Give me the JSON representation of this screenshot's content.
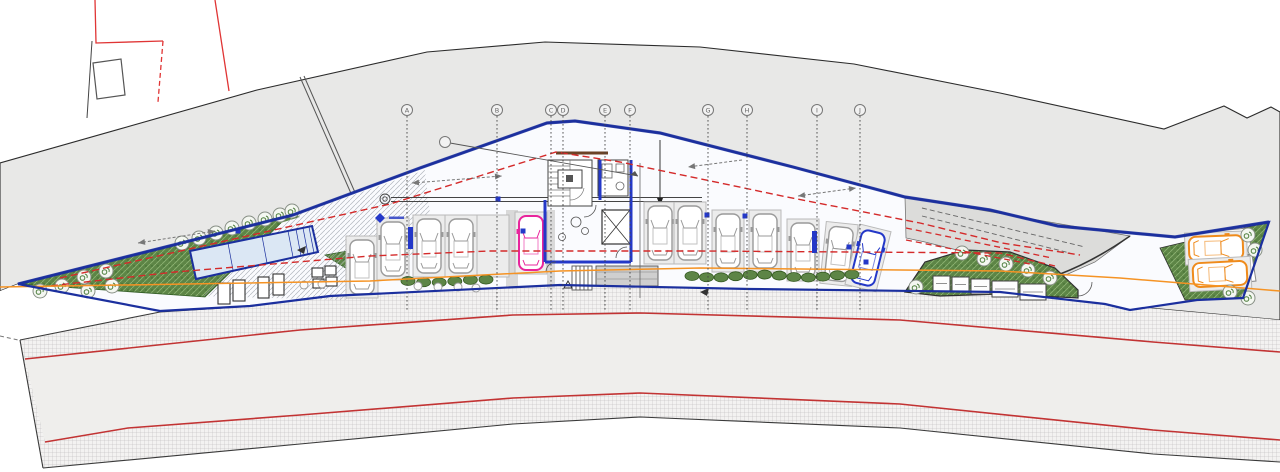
{
  "meta": {
    "drawing_type": "architectural-site-plan-garage-level",
    "canvas": {
      "width": 1280,
      "height": 472
    }
  },
  "colors": {
    "outline_blue": "#1b2f9e",
    "wall_blue": "#2438c8",
    "parcel_red": "#e03535",
    "dash_red": "#d42a2a",
    "road_red": "#c23333",
    "guide_orange": "#f59324",
    "site_gray": "#e8e8e7",
    "ramp_gray": "#dcdcda",
    "road_asphalt": "#efeeec",
    "hatch_gray": "#b5b5b5",
    "green_fill": "#5d8546",
    "green_dark": "#33591f",
    "car_gray": "#9a9a9a",
    "car_pink": "#e8259c",
    "car_blue": "#2438c8",
    "car_orange": "#ef8b1c",
    "line_black": "#2b2b2b"
  },
  "grid": {
    "bubble_y": 110,
    "line_top": 116,
    "line_bottom": 310,
    "bubbles": [
      {
        "label": "A",
        "x": 407
      },
      {
        "label": "B",
        "x": 497
      },
      {
        "label": "C",
        "x": 551
      },
      {
        "label": "D",
        "x": 563
      },
      {
        "label": "E",
        "x": 605
      },
      {
        "label": "F",
        "x": 630
      },
      {
        "label": "G",
        "x": 708
      },
      {
        "label": "H",
        "x": 747
      },
      {
        "label": "I",
        "x": 817
      },
      {
        "label": "J",
        "x": 860
      }
    ],
    "leader_tag": {
      "label": "",
      "cx": 445,
      "cy": 142,
      "x2": 638,
      "y2": 176
    }
  },
  "cars": {
    "gray": [
      {
        "cx": 362,
        "cy": 267,
        "rot": 0
      },
      {
        "cx": 393,
        "cy": 249,
        "rot": 0
      },
      {
        "cx": 429,
        "cy": 246,
        "rot": 0
      },
      {
        "cx": 461,
        "cy": 246,
        "rot": 0
      },
      {
        "cx": 660,
        "cy": 233,
        "rot": 0
      },
      {
        "cx": 690,
        "cy": 233,
        "rot": 0
      },
      {
        "cx": 728,
        "cy": 241,
        "rot": 0
      },
      {
        "cx": 765,
        "cy": 241,
        "rot": 0
      },
      {
        "cx": 803,
        "cy": 250,
        "rot": 0
      },
      {
        "cx": 839,
        "cy": 254,
        "rot": 6
      }
    ],
    "pink": [
      {
        "cx": 531,
        "cy": 243,
        "rot": 0
      }
    ],
    "blue": [
      {
        "cx": 868,
        "cy": 258,
        "rot": 14
      }
    ],
    "orange": [
      {
        "cx": 1216,
        "cy": 248,
        "rot": 88
      },
      {
        "cx": 1220,
        "cy": 274,
        "rot": 87
      }
    ],
    "empty_stalls": [
      {
        "cx": 493,
        "cy": 246,
        "rot": 0
      }
    ]
  },
  "trees": {
    "left_cluster": [
      [
        62,
        286
      ],
      [
        84,
        277
      ],
      [
        106,
        271
      ],
      [
        88,
        291
      ],
      [
        112,
        286
      ],
      [
        40,
        291
      ]
    ],
    "left_row": [
      [
        182,
        243
      ],
      [
        199,
        238
      ],
      [
        216,
        233
      ],
      [
        232,
        228
      ],
      [
        249,
        223
      ],
      [
        265,
        219
      ],
      [
        280,
        215
      ],
      [
        292,
        211
      ]
    ],
    "berm": [
      [
        916,
        287
      ],
      [
        962,
        253
      ],
      [
        984,
        259
      ],
      [
        1006,
        264
      ],
      [
        1028,
        270
      ],
      [
        1050,
        278
      ],
      [
        1000,
        290
      ]
    ],
    "right_green": [
      [
        1248,
        235
      ],
      [
        1255,
        250
      ],
      [
        1230,
        292
      ],
      [
        1248,
        298
      ]
    ]
  },
  "bushes": {
    "rows": [
      {
        "x1": 408,
        "x2": 486,
        "y": 281,
        "n": 6
      },
      {
        "x1": 692,
        "x2": 852,
        "y": 276,
        "n": 12
      }
    ],
    "gray_circles": [
      [
        304,
        285
      ],
      [
        322,
        284
      ],
      [
        418,
        286
      ],
      [
        438,
        287
      ],
      [
        458,
        287
      ],
      [
        476,
        288
      ]
    ]
  },
  "bins": [
    {
      "x": 933,
      "y": 276,
      "w": 17,
      "h": 15
    },
    {
      "x": 952,
      "y": 277,
      "w": 17,
      "h": 15
    },
    {
      "x": 971,
      "y": 279,
      "w": 19,
      "h": 15
    },
    {
      "x": 992,
      "y": 281,
      "w": 26,
      "h": 16
    },
    {
      "x": 1020,
      "y": 284,
      "w": 26,
      "h": 16
    }
  ],
  "light_wells": [
    [
      218,
      283,
      12,
      21
    ],
    [
      233,
      280,
      12,
      21
    ],
    [
      258,
      277,
      11,
      21
    ],
    [
      273,
      274,
      11,
      21
    ],
    [
      312,
      268,
      11,
      9
    ],
    [
      325,
      266,
      11,
      9
    ],
    [
      313,
      279,
      11,
      9
    ],
    [
      326,
      277,
      11,
      9
    ]
  ],
  "markers": {
    "blue_squares": [
      [
        238,
        231
      ],
      [
        498,
        199
      ],
      [
        523,
        231
      ],
      [
        707,
        215
      ],
      [
        745,
        216
      ],
      [
        849,
        247
      ],
      [
        866,
        262
      ]
    ],
    "blue_bars": [
      [
        408,
        227
      ],
      [
        812,
        231
      ]
    ],
    "elevation_marker": {
      "x": 380,
      "y": 218
    },
    "direction_triangles": [
      [
        700,
        292
      ],
      [
        297,
        250
      ]
    ]
  },
  "arrows": [
    {
      "x1": 138,
      "y1": 243,
      "x2": 215,
      "y2": 231,
      "double": true
    },
    {
      "x1": 412,
      "y1": 183,
      "x2": 502,
      "y2": 176,
      "double": true
    },
    {
      "x1": 742,
      "y1": 160,
      "x2": 688,
      "y2": 167,
      "double": false
    },
    {
      "x1": 798,
      "y1": 196,
      "x2": 856,
      "y2": 188,
      "double": true
    }
  ],
  "guides": {
    "red_dash_upper": "60,278 390,204 556,152 620,162 787,197 920,223 1002,243 1080,255",
    "red_dash_lower": "40,287 175,272 370,256 490,251 700,251 1000,253 1055,266",
    "red_dash_ramp": [
      [
        906,
        228,
        1052,
        258
      ],
      [
        906,
        240,
        1030,
        264
      ]
    ],
    "gray_slope_dash": [
      [
        922,
        208,
        1085,
        247
      ],
      [
        922,
        216,
        1070,
        253
      ]
    ],
    "orange_path": "M0,287 L370,281 L560,271 L700,268 L1000,271 L1120,278 L1280,291"
  }
}
